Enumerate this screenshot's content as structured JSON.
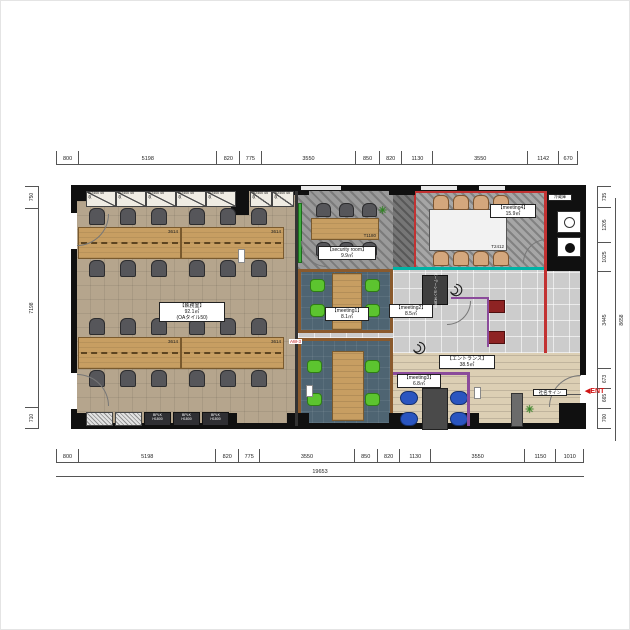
{
  "dimensions": {
    "top": {
      "segments": [
        "800",
        "5198",
        "820",
        "775",
        "3550",
        "850",
        "820",
        "1130",
        "3550",
        "1142",
        "670"
      ]
    },
    "bottom": {
      "segments": [
        "800",
        "5198",
        "820",
        "775",
        "3550",
        "850",
        "820",
        "1130",
        "3550",
        "1150",
        "1010"
      ],
      "total": "19653"
    },
    "left": {
      "segments": [
        "750",
        "7198",
        "710"
      ]
    },
    "right": {
      "segments": [
        "735",
        "1205",
        "1025",
        "3445",
        "673",
        "665",
        "700"
      ],
      "total": "8658"
    }
  },
  "rooms": {
    "office": {
      "name": "【執務室】",
      "area": "92.1㎡",
      "note": "(OAタイル50)"
    },
    "security": {
      "name": "【security room】",
      "area": "9.9㎡"
    },
    "meeting1": {
      "name": "【meeting1】",
      "area": "8.1㎡"
    },
    "meeting2": {
      "name": "【meeting2】",
      "area": "8.5㎡"
    },
    "meeting3": {
      "name": "【meeting3】",
      "area": "6.8㎡"
    },
    "meeting4": {
      "name": "【meeting4】",
      "area": "15.9㎡"
    },
    "entrance": {
      "name": "【エントランス】",
      "area": "38.5㎡"
    }
  },
  "furniture": {
    "desk_label": "3614",
    "security_table_label": "T1180",
    "meeting_table_label": "T2412",
    "wall_cabinet_label": "W2400 45",
    "wall_cabinet_sub": "収",
    "floor_cabinet_label": "BPLK",
    "floor_cabinet_sub": "H1800",
    "partition_label": "パーテーション H1800",
    "fridge_label": "冷蔵庫"
  },
  "annotations": {
    "entrance_marker": "ENT",
    "company_sign": "社名サイン",
    "window_tag": "AW-3"
  },
  "colors": {
    "wall": "#101010",
    "wood": "#c79e62",
    "meeting_floor": "#4e6472",
    "green_chair": "#5cc42f",
    "blue_chair": "#2a55c0",
    "accent_red": "#c23232",
    "accent_teal": "#00b3a6",
    "accent_purple": "#8b4b9b"
  }
}
